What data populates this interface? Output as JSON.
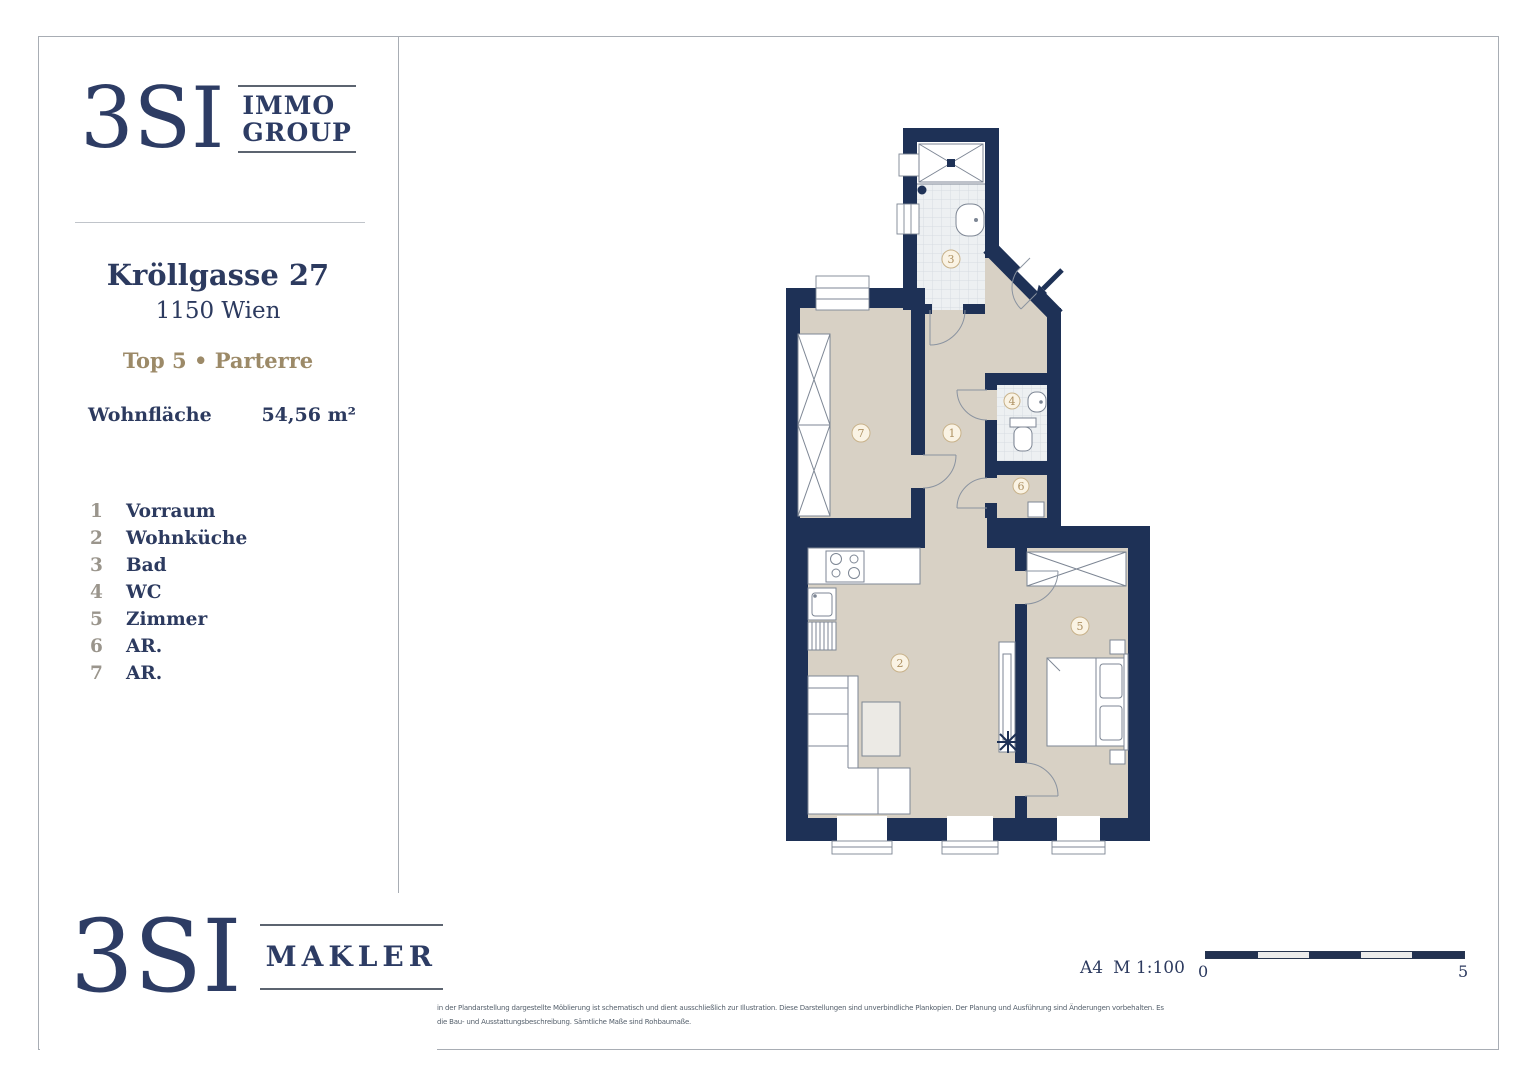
{
  "colors": {
    "navy_wall": "#1e3156",
    "logo_navy": "#2d3c64",
    "text_navy": "#2c3a5f",
    "accent_gold": "#9c8a68",
    "floor_beige": "#d8d1c5",
    "frame_gray": "#a8adb4"
  },
  "header_logo": {
    "brand": "3SI",
    "line1": "IMMO",
    "line2": "GROUP"
  },
  "sidebar": {
    "street": "Kröllgasse 27",
    "city": "1150 Wien",
    "unit_line": "Top 5 • Parterre",
    "area_label": "Wohnfläche",
    "area_value": "54,56 m²",
    "legend": [
      {
        "num": "1",
        "label": "Vorraum"
      },
      {
        "num": "2",
        "label": "Wohnküche"
      },
      {
        "num": "3",
        "label": "Bad"
      },
      {
        "num": "4",
        "label": "WC"
      },
      {
        "num": "5",
        "label": "Zimmer"
      },
      {
        "num": "6",
        "label": "AR."
      },
      {
        "num": "7",
        "label": "AR."
      }
    ]
  },
  "footer_logo": {
    "brand": "3SI",
    "suffix": "MAKLER"
  },
  "plan": {
    "room_numbers": {
      "vorraum": "1",
      "wohnkueche": "2",
      "bad": "3",
      "wc": "4",
      "zimmer": "5",
      "ar6": "6",
      "ar7": "7"
    }
  },
  "scale": {
    "sheet": "A4",
    "ratio": "M 1:100",
    "bar_start": "0",
    "bar_end": "5"
  },
  "disclaimer": {
    "line1": "in der Plandarstellung dargestellte Möblierung ist schematisch und dient ausschließlich zur Illustration. Diese Darstellungen sind unverbindliche Plankopien. Der Planung und Ausführung sind Änderungen vorbehalten. Es",
    "line2": "die Bau- und Ausstattungsbeschreibung. Sämtliche Maße sind Rohbaumaße."
  }
}
